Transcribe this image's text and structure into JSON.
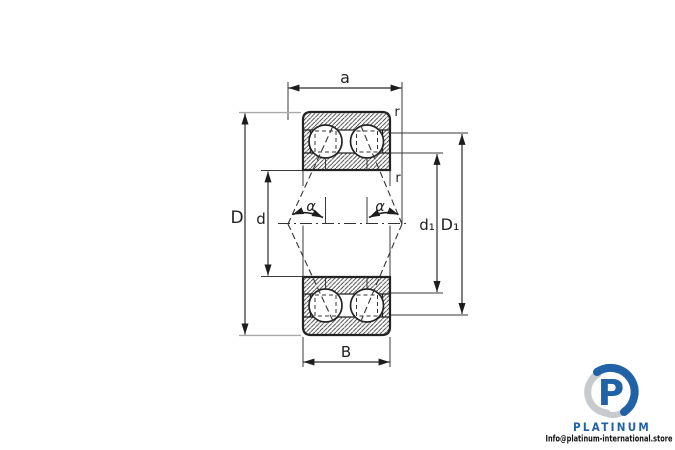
{
  "drawing": {
    "title": "double-row angular contact bearing cross-section",
    "dimension_labels": {
      "a": "a",
      "D": "D",
      "d": "d",
      "d1": "d₁",
      "D1": "D₁",
      "B": "B",
      "r_top": "r",
      "r_side": "r",
      "alpha_left": "α",
      "alpha_right": "α"
    },
    "colors": {
      "line": "#2b2b2b",
      "extension_gray": "#a8a8a8"
    }
  },
  "branding": {
    "logo_letter": "P",
    "wordmark": "PLATINUM",
    "contact": "Info@platinum-international.store",
    "colors": {
      "blue": "#2062a5",
      "gray": "#c8cbce",
      "text": "#111111"
    }
  }
}
